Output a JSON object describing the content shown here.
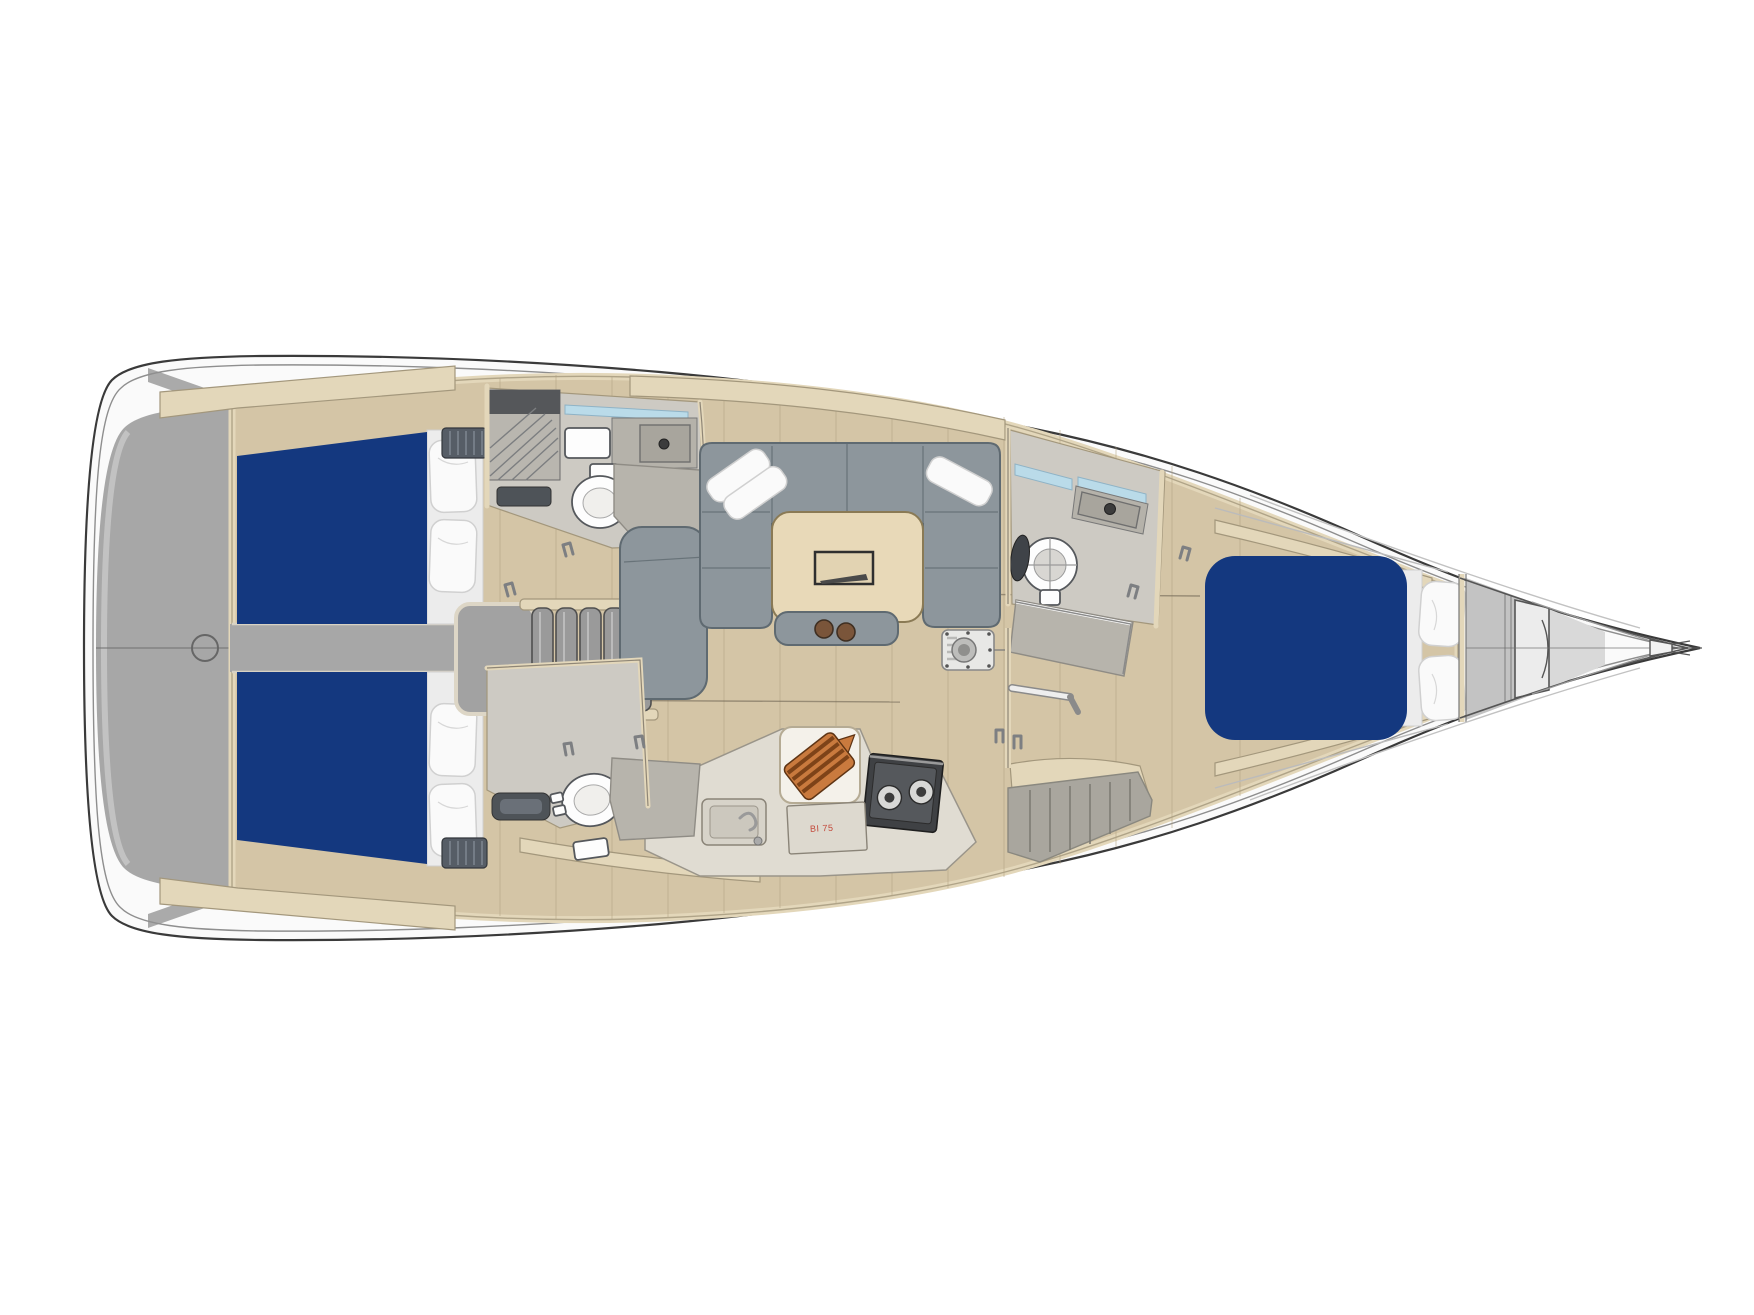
{
  "meta": {
    "title": "Sailboat interior deck plan (top view, bow to the right)",
    "diagram_type": "boat-floor-plan"
  },
  "labels": {
    "fridge_label": "BI 75"
  },
  "zones": [
    {
      "name": "transom-platform",
      "desc": "grey stern platform"
    },
    {
      "name": "aft-cabin-top",
      "desc": "aft double cabin with navy mattress and two pillows"
    },
    {
      "name": "aft-cabin-bottom",
      "desc": "aft double cabin with navy mattress and two pillows"
    },
    {
      "name": "companionway-stairs",
      "desc": "entry steps"
    },
    {
      "name": "head-top",
      "desc": "bathroom with toilet, sink and shower"
    },
    {
      "name": "head-bottom",
      "desc": "bathroom with toilet and shower"
    },
    {
      "name": "salon",
      "desc": "U-shaped settee with dining table"
    },
    {
      "name": "galley",
      "desc": "kitchen with sink, stove, fridge and cutting board"
    },
    {
      "name": "head-forward",
      "desc": "forward bathroom with toilet, sink, shower"
    },
    {
      "name": "forward-cabin",
      "desc": "V-berth with navy mattress and two pillows"
    },
    {
      "name": "anchor-locker",
      "desc": "bow locker and bowsprit"
    }
  ],
  "colors": {
    "background": "#ffffff",
    "hull_outline": "#3a3a3a",
    "hull_fill": "#fafafa",
    "deck_line": "#8e8e8e",
    "transom": "#a7a7a7",
    "transom_light": "#c9c9c9",
    "wood": "#d4c5a6",
    "wood_seam": "#b1a07f",
    "seam_dark": "#6f6555",
    "cream": "#e3d7ba",
    "cream_line": "#a3977c",
    "mattress_navy": "#14387f",
    "sofa": "#8d969c",
    "sofa_line": "#5f6a71",
    "pillow": "#fafafa",
    "pillow_line": "#d0d0d0",
    "head_floor": "#cdcac3",
    "shower": "#b7b4ac",
    "fixture": "#fdfdfd",
    "fixture_line": "#55585c",
    "basin": "#a8a59d",
    "counter": "#e0dcd2",
    "stove_dark": "#3f4144",
    "board_light": "#c97a3e",
    "board_dark": "#7e4318",
    "window": "#badbe9",
    "metal": "#9a9a9a",
    "label_red": "#c34a3c",
    "table_wood": "#e8d9b8"
  }
}
